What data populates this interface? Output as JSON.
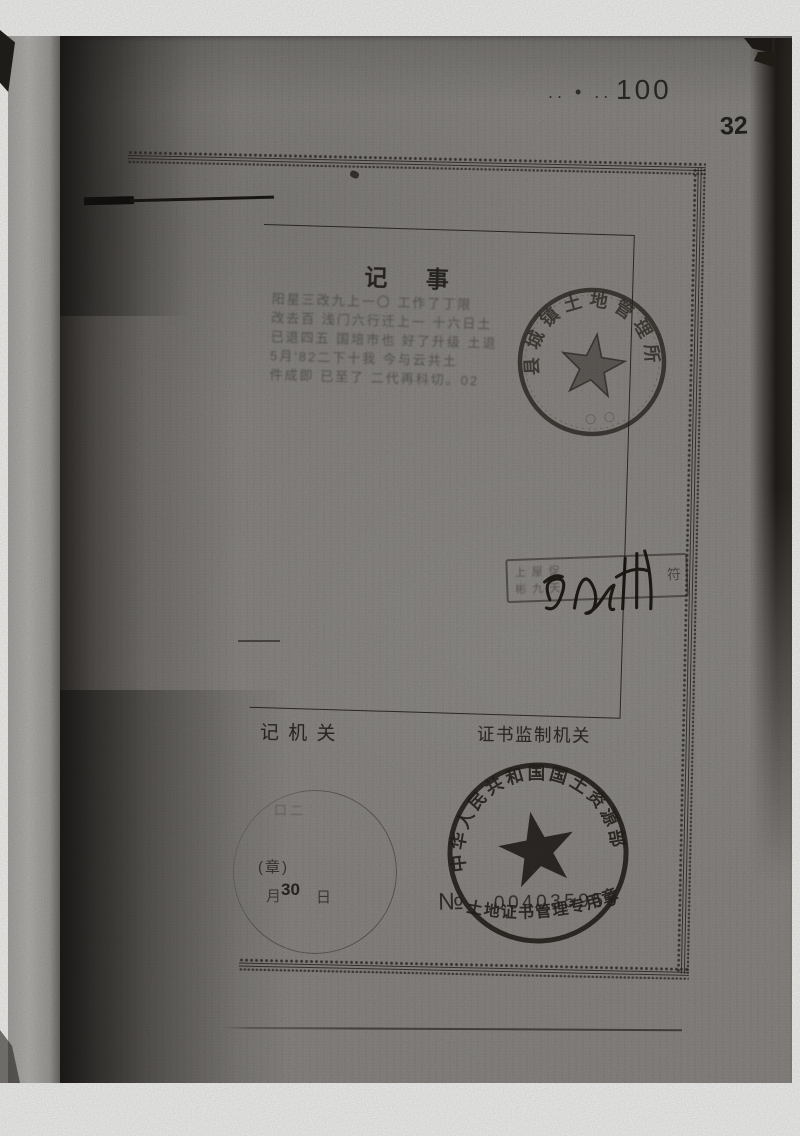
{
  "corner": {
    "dots": ".. • .. .",
    "number": "100",
    "page_number": "32"
  },
  "record": {
    "heading": "记 事",
    "handwriting_lines": [
      "阳星三改九上一〇 工作了丁限",
      "改去百 浅门六行迁上一 十六日土",
      "已退四五 国培市也 好了升级 土退",
      "5月'82二下十我 今与云共土",
      "件成即 已至了 二代再科切。02"
    ]
  },
  "office_seal": {
    "arc_text": "县城镇土地管理所",
    "bottom_text": "〇〇"
  },
  "signature_area": {
    "box_row1": "上屋促",
    "box_row2": "彬九天",
    "box_right_char": "符"
  },
  "labels": {
    "registry_agency": "记 机 关",
    "certificate_supervision": "证书监制机关"
  },
  "date_stamp": {
    "scribble": "口二",
    "seal_note": "(章)",
    "month": "月",
    "day_value": "30",
    "day": "日"
  },
  "ministry_seal": {
    "top_arc": "中华人民共和国国土资源部",
    "bottom_arc": "土地证书管理专用章"
  },
  "serial": {
    "no_symbol": "№",
    "number": "004035959",
    "suffix": "s"
  },
  "colors": {
    "paper": "#8f8c88",
    "ink": "#26231f",
    "stamp_ink": "#241f1a"
  }
}
